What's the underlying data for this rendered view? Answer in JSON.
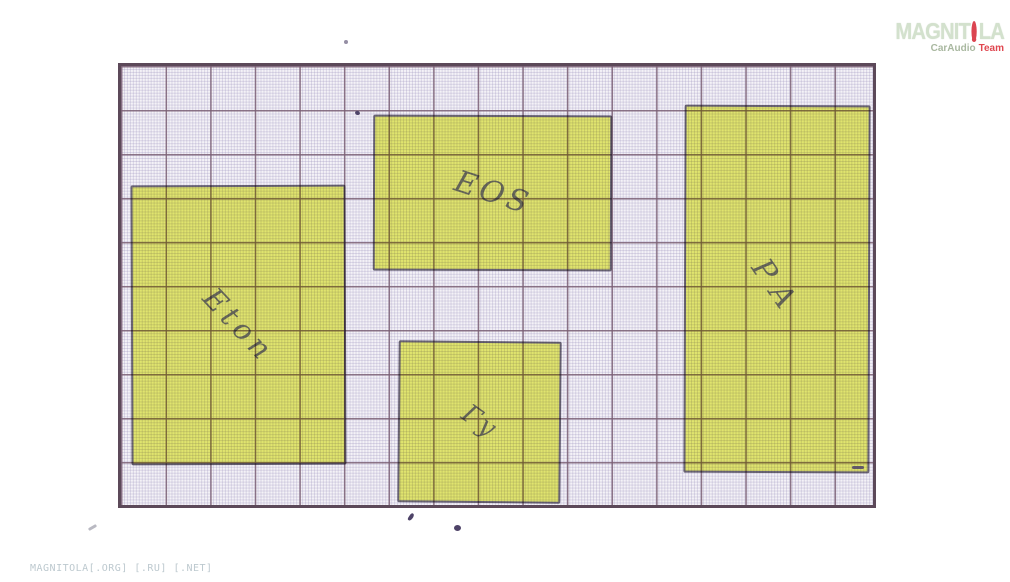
{
  "watermark_logo": {
    "brand_prefix": "MAGNIT",
    "brand_suffix": "LA",
    "subtitle_primary": "CarAudio",
    "subtitle_accent": "Team",
    "brand_color": "#d3e1cd",
    "accent_color": "#e04750",
    "subtitle_color": "#a9b8a0"
  },
  "footer": {
    "watermark_text": "MAGNITOLA[.ORG] [.RU] [.NET]"
  },
  "diagram": {
    "paper_color": "#f4f2f7",
    "paper_border_color": "#5c4959",
    "grid_major_color": "#7a5f74",
    "grid_fine_color": "#968cb9",
    "highlight_color": "#eaf171",
    "ink_color": "#524b7a",
    "handwriting_color": "#6f715e",
    "blocks": [
      {
        "label": "Eton"
      },
      {
        "label": "EOS"
      },
      {
        "label": "Гу"
      },
      {
        "label": "PA"
      }
    ]
  }
}
